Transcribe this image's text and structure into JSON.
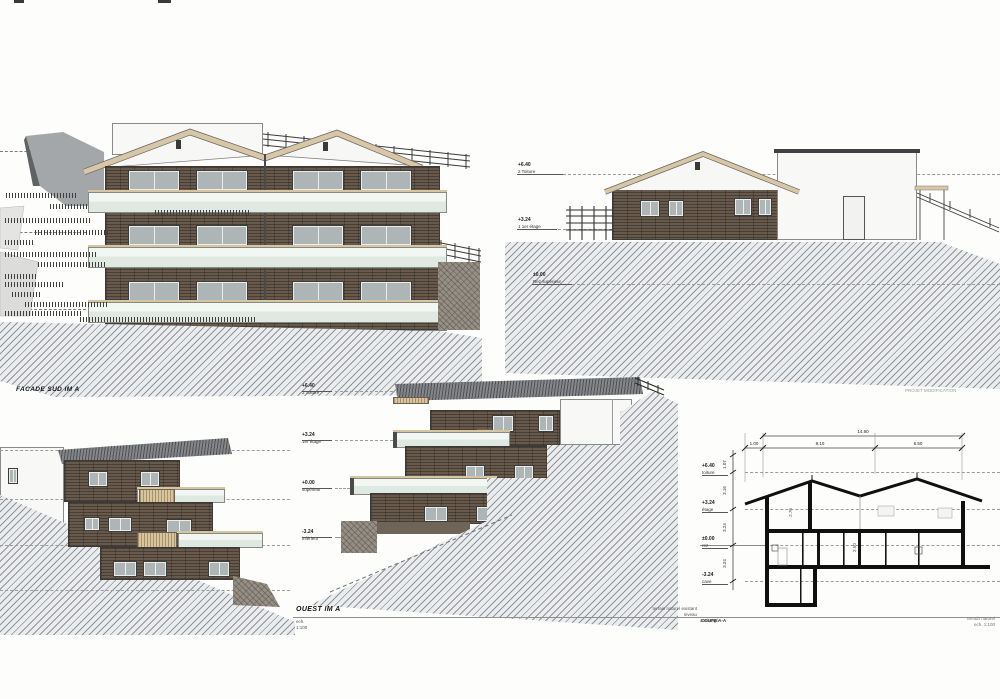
{
  "south": {
    "label": "FACADE SUD IM A"
  },
  "north": {
    "levels": [
      {
        "value": "+6.40",
        "name": "2 Toiture"
      },
      {
        "value": "+3.24",
        "name": "1 1er étage"
      },
      {
        "value": "±0.00",
        "name": "Rez supérieur"
      }
    ]
  },
  "west": {
    "label": "OUEST IM A",
    "scale_label": "ech.",
    "scale_value": "1:100",
    "levels": [
      {
        "value": "+6.40",
        "name": "2 Toiture"
      },
      {
        "value": "+3.24",
        "name": "1er étage"
      },
      {
        "value": "+0.00",
        "name": "supérieur"
      },
      {
        "value": "-3.24",
        "name": "inférieur"
      }
    ],
    "note1": "terrain naturel existant",
    "note2": "niveau",
    "note3": "aménagé"
  },
  "section": {
    "sheet_note": "PROJET MODIFICATION",
    "dims_top": {
      "total": "14.60",
      "segments": [
        "1.00",
        "8.10",
        "6.50"
      ]
    },
    "dims_left": [
      "1.07",
      "3.16",
      "3.24",
      "3.24"
    ],
    "levels": [
      {
        "value": "+6.40",
        "name": "toiture"
      },
      {
        "value": "+3.24",
        "name": "étage"
      },
      {
        "value": "±0.00",
        "name": "rez"
      },
      {
        "value": "-3.24",
        "name": "cave"
      }
    ],
    "inner_dims": [
      "2.70",
      "2.50"
    ],
    "label": "COUPE A-A",
    "corner_note1": "terrain naturel",
    "corner_note2": "ech. 1:100"
  }
}
